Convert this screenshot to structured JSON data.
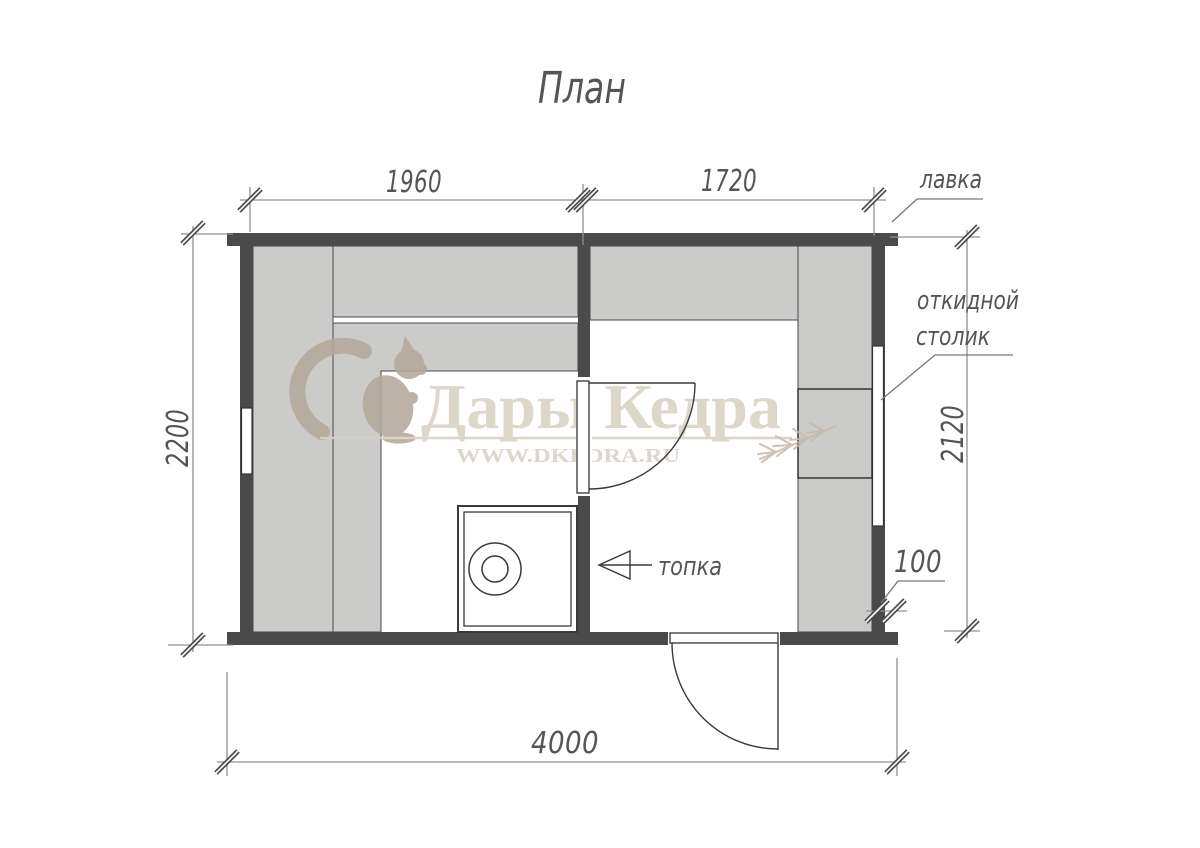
{
  "title": "План",
  "watermark": {
    "brand": "Дары Кедра",
    "site": "WWW.DKEDRA.RU"
  },
  "dimensions": {
    "top_left_mm": "1960",
    "top_right_mm": "1720",
    "left_mm": "2200",
    "right_mm": "2120",
    "bottom_mm": "4000",
    "wall_mm": "100"
  },
  "labels": {
    "bench": "лавка",
    "folding_table_line1": "откидной",
    "folding_table_line2": "столик",
    "firebox": "топка"
  },
  "colors": {
    "wall": "#4a4a4a",
    "bench_fill": "#cbcbca",
    "dim_text": "#555555",
    "watermark_text": "#d9d1c4",
    "watermark_logo": "#b5a89b"
  }
}
